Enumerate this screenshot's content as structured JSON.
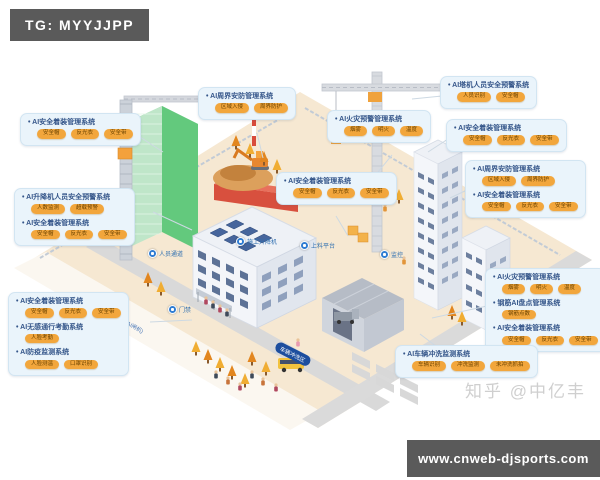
{
  "badge": {
    "text": "TG: MYYJJPP"
  },
  "watermark": {
    "text": "知乎 @中亿丰"
  },
  "footer": {
    "url": "www.cnweb-djsports.com"
  },
  "colors": {
    "callout_bg": "#eaf4fb",
    "tag_orange": "#f2a63c",
    "marker_blue": "#2f7cd2",
    "badge_gray": "#5a5a5a",
    "title_blue": "#35568a"
  },
  "callouts": [
    {
      "items": [
        {
          "title": "AI安全着装管理系统",
          "tags": [
            "安全帽",
            "反光衣",
            "安全带"
          ]
        }
      ]
    },
    {
      "items": [
        {
          "title": "AI升降机人员安全预警系统",
          "tags": [
            "人数监测",
            "超载预警"
          ]
        },
        {
          "title": "AI安全着装管理系统",
          "tags": [
            "安全帽",
            "反光衣",
            "安全带"
          ]
        }
      ]
    },
    {
      "items": [
        {
          "title": "AI安全着装管理系统",
          "tags": [
            "安全帽",
            "反光衣",
            "安全带"
          ]
        },
        {
          "title": "AI无感通行考勤系统",
          "tags": [
            "人脸考勤"
          ]
        },
        {
          "title": "AI防疫监测系统",
          "tags": [
            "人脸测温",
            "口罩识别"
          ]
        }
      ]
    },
    {
      "items": [
        {
          "title": "AI周界安防管理系统",
          "tags": [
            "区域入侵",
            "周界防护"
          ]
        }
      ]
    },
    {
      "items": [
        {
          "title": "AI火灾预警管理系统",
          "tags": [
            "烟雾",
            "明火",
            "温度"
          ]
        }
      ]
    },
    {
      "items": [
        {
          "title": "AI安全着装管理系统",
          "tags": [
            "安全帽",
            "反光衣",
            "安全带"
          ]
        }
      ]
    },
    {
      "items": [
        {
          "title": "AI塔机人员安全预警系统",
          "tags": [
            "人员识别",
            "安全帽"
          ]
        }
      ]
    },
    {
      "items": [
        {
          "title": "AI安全着装管理系统",
          "tags": [
            "安全帽",
            "反光衣",
            "安全带"
          ]
        }
      ]
    },
    {
      "items": [
        {
          "title": "AI周界安防管理系统",
          "tags": [
            "区域入侵",
            "周界防护"
          ]
        },
        {
          "title": "AI安全着装管理系统",
          "tags": [
            "安全帽",
            "反光衣",
            "安全带"
          ]
        }
      ]
    },
    {
      "items": [
        {
          "title": "AI火灾预警管理系统",
          "tags": [
            "烟雾",
            "明火",
            "温度"
          ]
        },
        {
          "title": "钢筋AI盘点管理系统",
          "tags": [
            "钢筋点数"
          ]
        },
        {
          "title": "AI安全着装管理系统",
          "tags": [
            "安全帽",
            "反光衣",
            "安全带"
          ]
        }
      ]
    },
    {
      "items": [
        {
          "title": "AI车辆冲洗监测系统",
          "tags": [
            "车辆识别",
            "冲洗监测",
            "未冲洗抓拍"
          ]
        }
      ]
    }
  ],
  "markers": [
    {
      "label": "人员通道"
    },
    {
      "label": "门禁"
    },
    {
      "label": "施工升降机"
    },
    {
      "label": "上料平台"
    },
    {
      "label": "监控"
    },
    {
      "label": "车辆门禁"
    }
  ],
  "road_labels": [
    {
      "text": "人行出入口(AI闸机)"
    },
    {
      "text": "车辆冲洗区"
    }
  ]
}
